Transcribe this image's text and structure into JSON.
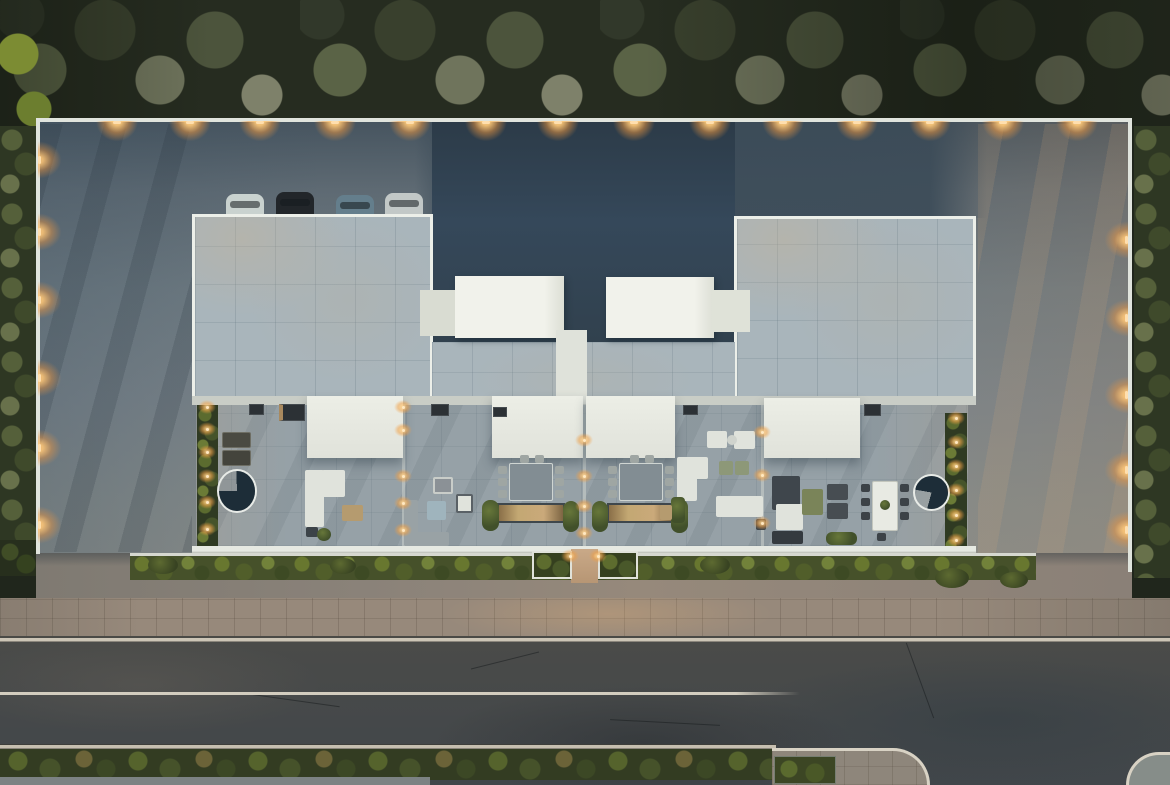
{
  "scene": {
    "description": "Top-down aerial 3D architectural render at dusk of a modern flat-roof terraced residence with four units, rear parking court, furnished roof terraces, front hedge, sidewalk and asphalt street with a side-road junction",
    "time_of_day": "dusk",
    "view": "top-down aerial",
    "counts": {
      "housing_units": 4,
      "parked_cars": 4,
      "perimeter_downlights_top_wall": 14,
      "left_wall_lights": 6,
      "right_wall_lights": 5,
      "terrace_pathway_spotlights": 29,
      "skylight_roof_volumes": 4,
      "white_terrace_awnings": 4,
      "spiral_stair_circles": 2,
      "outdoor_dining_sets": 3
    },
    "features": [
      "tree canopy along top edge",
      "green vegetation strips on left and right boundaries",
      "concrete parking court with tree-shadow streaks",
      "two tiled roof blocks flanking dark recessed center court",
      "white skylight boxes on center roof",
      "roof terraces with sofas, loungers, dining tables and planters",
      "continuous front hedge with central entry path and white planters",
      "paved sidewalk with warm entry glow",
      "two-lane asphalt road with cream lane line",
      "curved curb junction with paved island at bottom right"
    ],
    "cars": [
      {
        "color_name": "white",
        "hex": "#c9d2cf"
      },
      {
        "color_name": "black",
        "hex": "#22262a"
      },
      {
        "color_name": "steel-blue",
        "hex": "#647e8c"
      },
      {
        "color_name": "silver",
        "hex": "#c2c8c7"
      }
    ]
  },
  "palette": {
    "trees": "#262c20",
    "court": "#35485a",
    "roof-tile": "#a9b5bb",
    "parapet": "#ecefe9",
    "terrace": "#96a1a7",
    "awning": "#eceee6",
    "hedge": "#46512a",
    "sidewalk": "#97897b",
    "curb": "#ccc5b6",
    "road": "#46484a",
    "lane": "#d3cdbf",
    "glow": "#f0a050"
  },
  "lights": {
    "top_wall": {
      "style": "glow-down",
      "points": [
        [
          117,
          121
        ],
        [
          190,
          121
        ],
        [
          260,
          121
        ],
        [
          335,
          121
        ],
        [
          410,
          121
        ],
        [
          486,
          121
        ],
        [
          558,
          121
        ],
        [
          634,
          121
        ],
        [
          710,
          121
        ],
        [
          783,
          121
        ],
        [
          857,
          121
        ],
        [
          930,
          121
        ],
        [
          1003,
          121
        ],
        [
          1077,
          121
        ]
      ]
    },
    "left_wall": {
      "style": "glow-right",
      "points": [
        [
          38,
          160
        ],
        [
          38,
          232
        ],
        [
          38,
          300
        ],
        [
          38,
          378
        ],
        [
          38,
          448
        ],
        [
          38,
          525
        ]
      ]
    },
    "right_wall": {
      "style": "glow-left",
      "points": [
        [
          1098,
          240
        ],
        [
          1098,
          318
        ],
        [
          1098,
          395
        ],
        [
          1098,
          470
        ],
        [
          1098,
          530
        ]
      ]
    },
    "strip_left": {
      "style": "spot",
      "points": [
        [
          207,
          407
        ],
        [
          207,
          429
        ],
        [
          207,
          452
        ],
        [
          207,
          476
        ],
        [
          207,
          502
        ],
        [
          207,
          529
        ]
      ]
    },
    "strip_right": {
      "style": "spot",
      "points": [
        [
          956,
          418
        ],
        [
          956,
          442
        ],
        [
          956,
          466
        ],
        [
          956,
          490
        ],
        [
          956,
          515
        ],
        [
          956,
          540
        ]
      ]
    },
    "party_wall_1": {
      "style": "spot",
      "points": [
        [
          403,
          407
        ],
        [
          403,
          430
        ],
        [
          403,
          476
        ],
        [
          403,
          503
        ],
        [
          403,
          530
        ]
      ]
    },
    "party_wall_2": {
      "style": "spot",
      "points": [
        [
          584,
          440
        ],
        [
          584,
          476
        ],
        [
          584,
          506
        ],
        [
          584,
          533
        ]
      ]
    },
    "party_wall_3": {
      "style": "spot",
      "points": [
        [
          762,
          432
        ],
        [
          762,
          475
        ],
        [
          762,
          523
        ]
      ]
    },
    "entry_path": {
      "style": "spot",
      "points": [
        [
          570,
          556
        ],
        [
          598,
          556
        ]
      ]
    }
  }
}
